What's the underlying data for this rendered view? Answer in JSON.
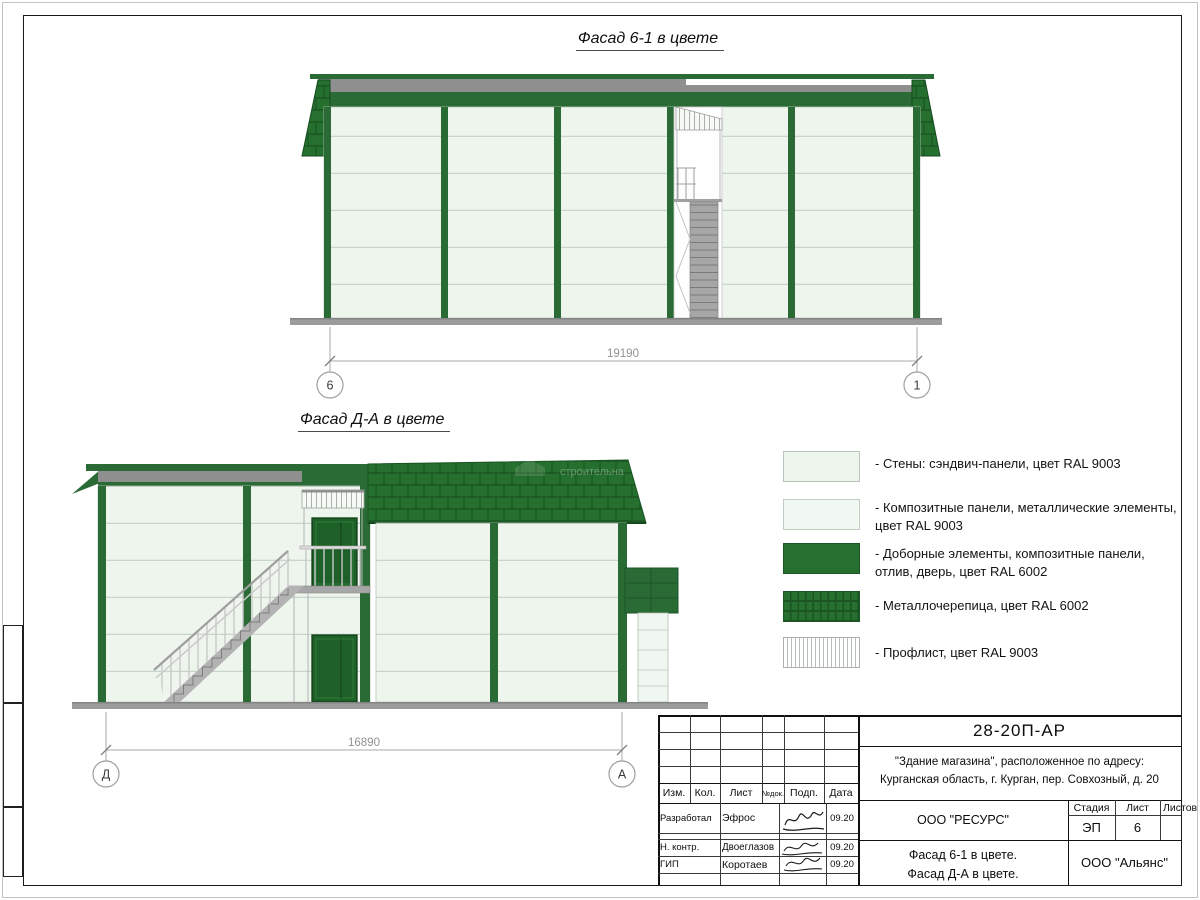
{
  "drawing": {
    "facade1": {
      "title": "Фасад 6-1 в цвете",
      "dimension": "19190",
      "axis_left": "6",
      "axis_right": "1"
    },
    "facade2": {
      "title": "Фасад Д-А в цвете",
      "dimension": "16890",
      "axis_left": "Д",
      "axis_right": "А",
      "watermark": "строительна"
    }
  },
  "legend": {
    "items": [
      {
        "swatch": "sandwich-panel-light",
        "label": "- Стены: сэндвич-панели, цвет RAL 9003"
      },
      {
        "swatch": "composite-panel-light",
        "label": "- Композитные панели, металлические элементы, цвет RAL 9003"
      },
      {
        "swatch": "solid-green",
        "label": "- Доборные элементы,  композитные панели, отлив, дверь, цвет RAL 6002"
      },
      {
        "swatch": "metal-tile-green",
        "label": "- Металлочерепица, цвет RAL 6002"
      },
      {
        "swatch": "proflist-stripes",
        "label": "- Профлист, цвет RAL 9003"
      }
    ]
  },
  "title_block": {
    "code": "28-20П-АР",
    "object_line1": "\"Здание магазина\", расположенное по адресу:",
    "object_line2": "Курганская область, г. Курган, пер. Совхозный, д. 20",
    "designer_org": "ООО \"РЕСУРС\"",
    "stage_label": "Стадия",
    "sheet_label": "Лист",
    "sheets_label": "Листов",
    "stage": "ЭП",
    "sheet": "6",
    "sheet_title_line1": "Фасад 6-1 в цвете.",
    "sheet_title_line2": "Фасад Д-А в цвете.",
    "company": "ООО \"Альянс\"",
    "columns": [
      "Изм.",
      "Кол.",
      "Лист",
      "№док.",
      "Подп.",
      "Дата"
    ],
    "rows": [
      {
        "role": "Разработал",
        "name": "Эфрос",
        "date": "09.20"
      },
      {
        "role": "Н. контр.",
        "name": "Двоеглазов",
        "date": "09.20"
      },
      {
        "role": "ГИП",
        "name": "Коротаев",
        "date": "09.20"
      }
    ]
  },
  "colors": {
    "ral6002_green": "#26702f",
    "dark_green_elements": "#1d6128",
    "ral9003_light": "#edf5ed",
    "roof_strip_gray": "#8f8f8f",
    "dimension_gray": "#909090"
  }
}
